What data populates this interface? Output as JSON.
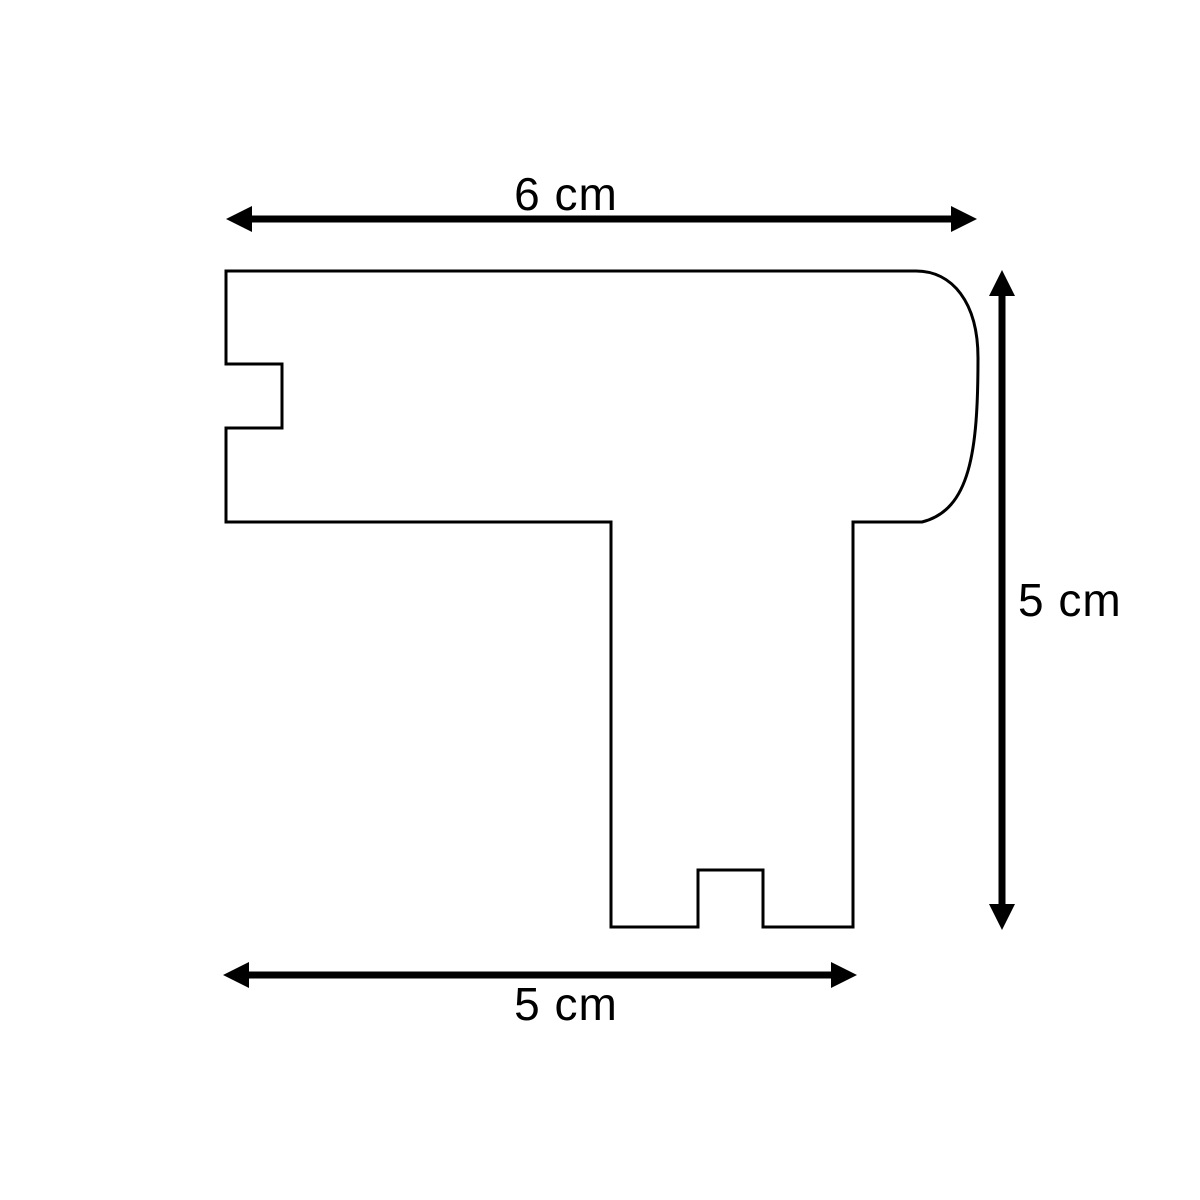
{
  "diagram": {
    "type": "dimensioned-profile-cross-section",
    "colors": {
      "line": "#000000",
      "background": "#ffffff"
    },
    "dimensions": {
      "top": {
        "label": "6 cm"
      },
      "right": {
        "label": "5 cm"
      },
      "bottom": {
        "label": "5 cm"
      }
    }
  }
}
